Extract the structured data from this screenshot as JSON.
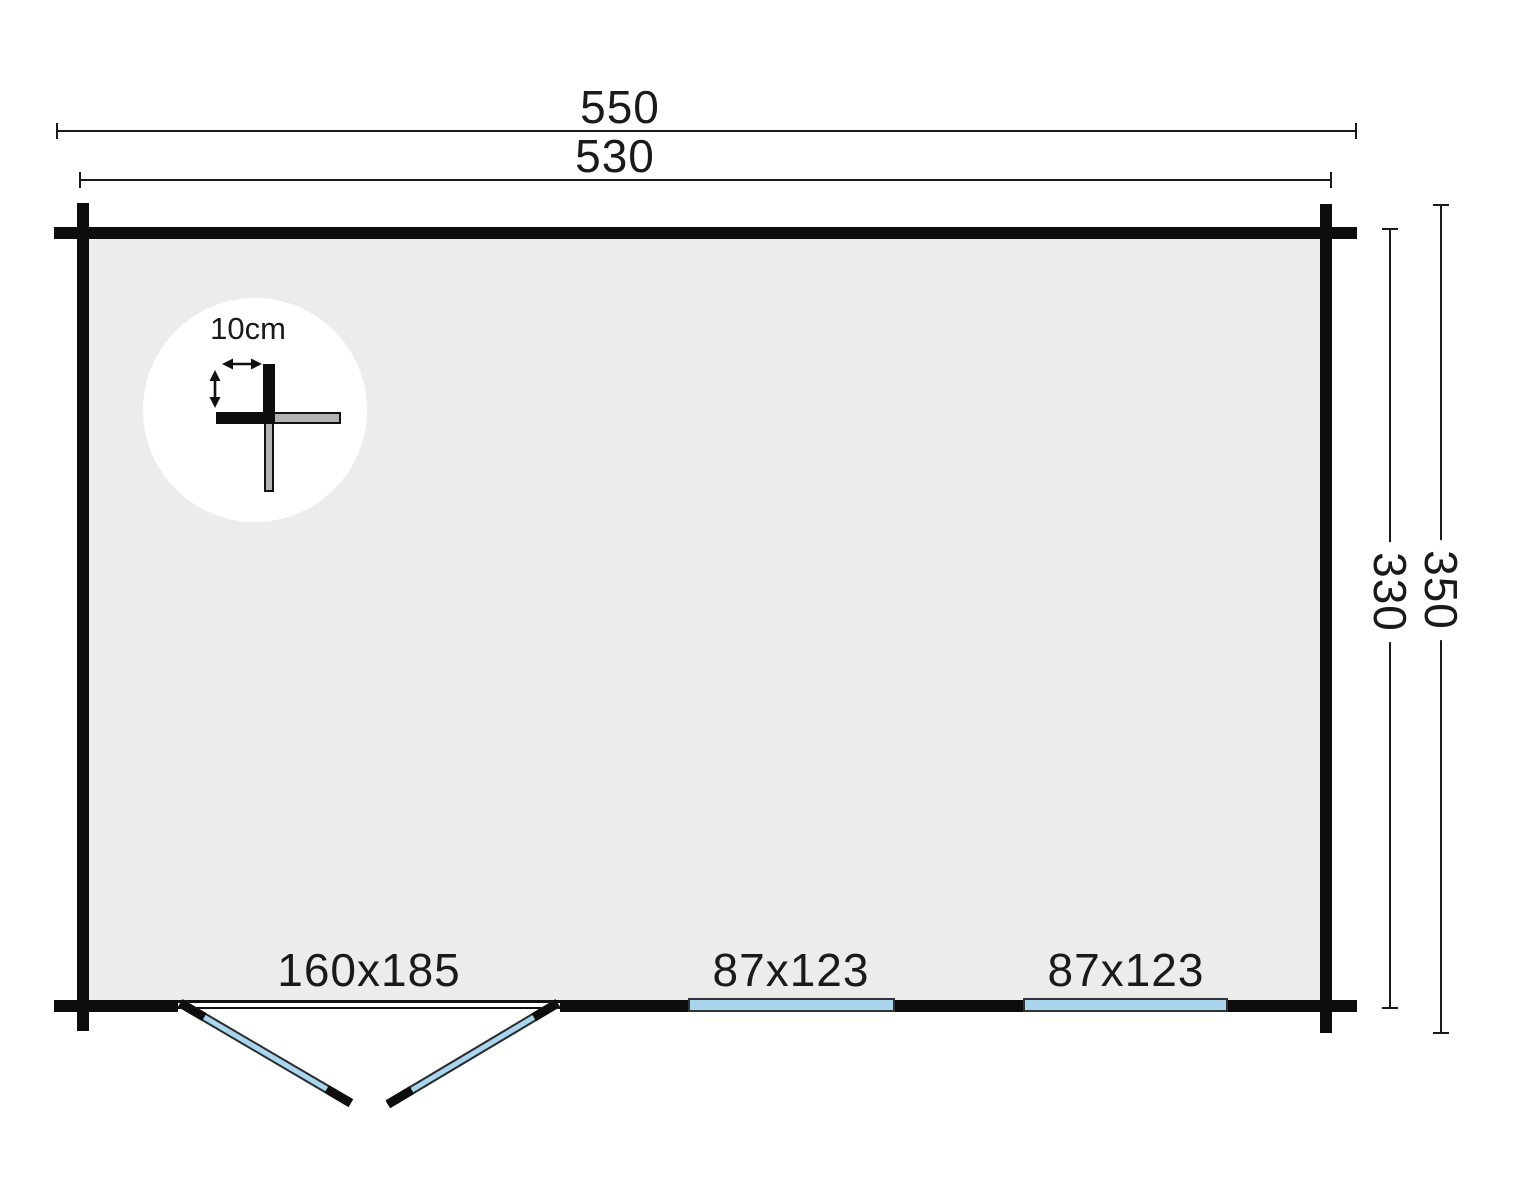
{
  "colors": {
    "background": "#ffffff",
    "wall": "#0d0d0d",
    "interior": "#ececec",
    "glazing_blue": "#a9d6ee",
    "dim_line": "#1a1a1a",
    "log_gray": "#b3b3b3"
  },
  "dimensions": {
    "outer_width": "550",
    "inner_width": "530",
    "outer_depth": "350",
    "inner_depth": "330"
  },
  "detail": {
    "wall_thickness_label": "10cm"
  },
  "openings": {
    "door": {
      "label": "160x185"
    },
    "window_left": {
      "label": "87x123"
    },
    "window_right": {
      "label": "87x123"
    }
  }
}
